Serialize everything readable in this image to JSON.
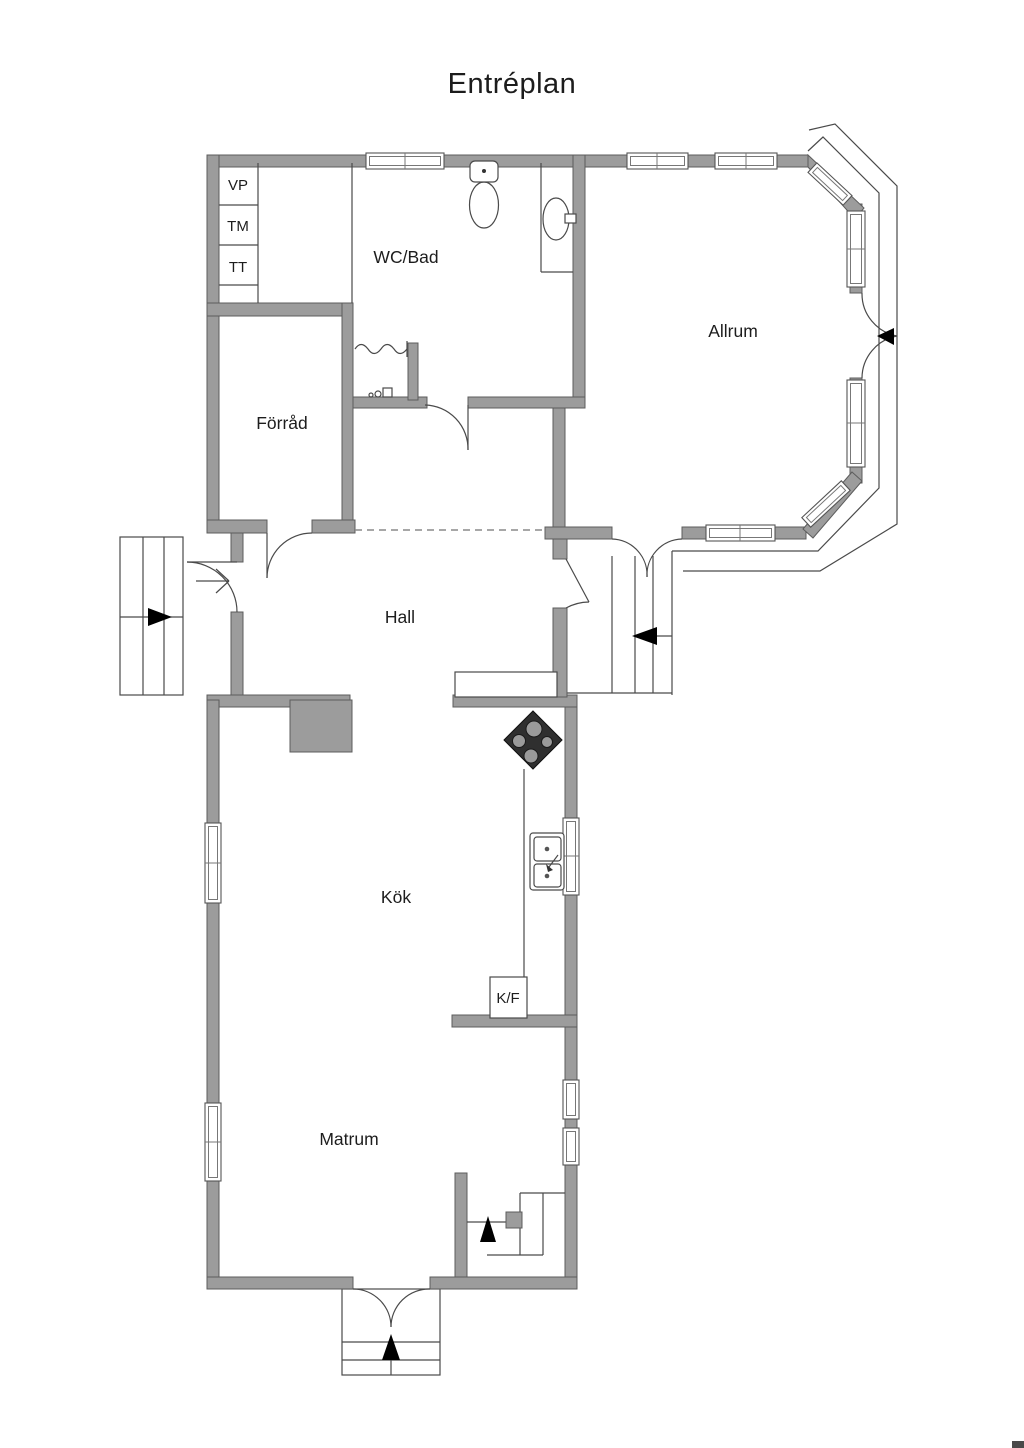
{
  "title": "Entréplan",
  "colors": {
    "background": "#ffffff",
    "wall_fill": "#9c9c9c",
    "wall_stroke": "#5c5c5c",
    "line": "#4a4a4a",
    "stove_dark": "#2f2f2f",
    "text": "#1d1d1d"
  },
  "rooms": {
    "wc_bad": {
      "label": "WC/Bad"
    },
    "allrum": {
      "label": "Allrum"
    },
    "forrad": {
      "label": "Förråd"
    },
    "hall": {
      "label": "Hall"
    },
    "kok": {
      "label": "Kök"
    },
    "matrum": {
      "label": "Matrum"
    }
  },
  "closets": {
    "vp": "VP",
    "tm": "TM",
    "tt": "TT"
  },
  "appliances": {
    "kf": "K/F"
  }
}
